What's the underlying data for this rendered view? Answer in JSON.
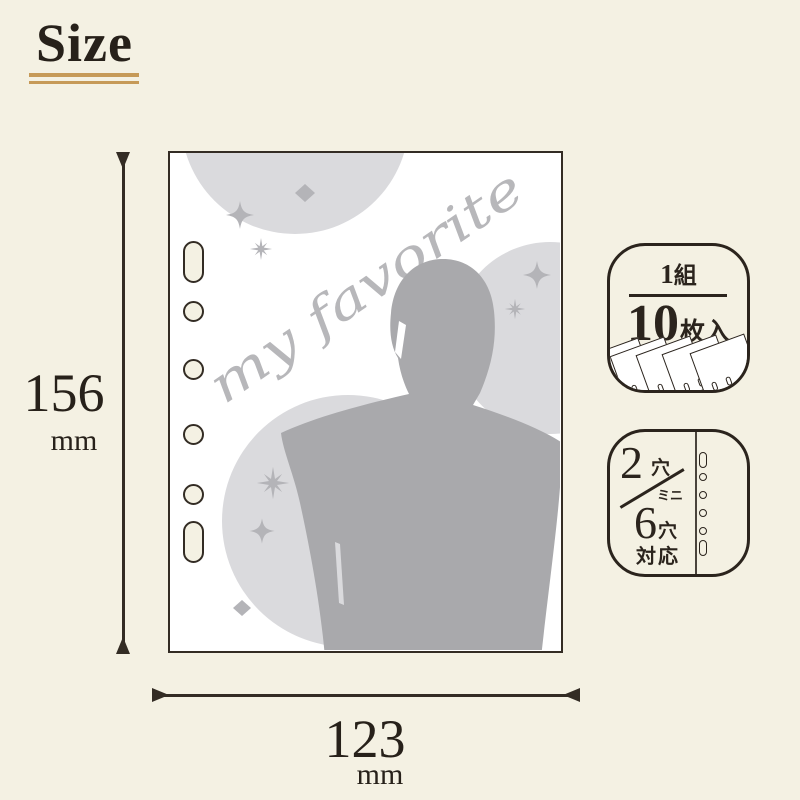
{
  "page": {
    "title": "Size"
  },
  "dimensions": {
    "height": {
      "value": "156",
      "unit": "mm"
    },
    "width": {
      "value": "123",
      "unit": "mm"
    }
  },
  "sleeve": {
    "script_text": "my favorite",
    "icons": {
      "person": "person-silhouette",
      "sparkles": [
        "four-point-sparkle",
        "eight-point-burst",
        "diamond"
      ],
      "holes": "binder-holes-slot-4round-slot"
    }
  },
  "badge_count": {
    "set_num": "1",
    "set_unit": "組",
    "quantity": "10",
    "quantity_unit": "枚入",
    "icon": "fanned-sheet-stack"
  },
  "badge_holes": {
    "two_num": "2",
    "two_unit": "穴",
    "mini": "ミニ",
    "six_num": "6",
    "six_unit": "穴",
    "support": "対応",
    "icon": "six-hole-column"
  },
  "colors": {
    "background": "#f4f1e3",
    "ink": "#2b241d",
    "gold_underline": "#c69a58",
    "sheet_white": "#ffffff",
    "circle_gray": "#dadadd",
    "silhouette_gray": "#a9a9ac",
    "accent_gray": "#b4b4b8"
  }
}
